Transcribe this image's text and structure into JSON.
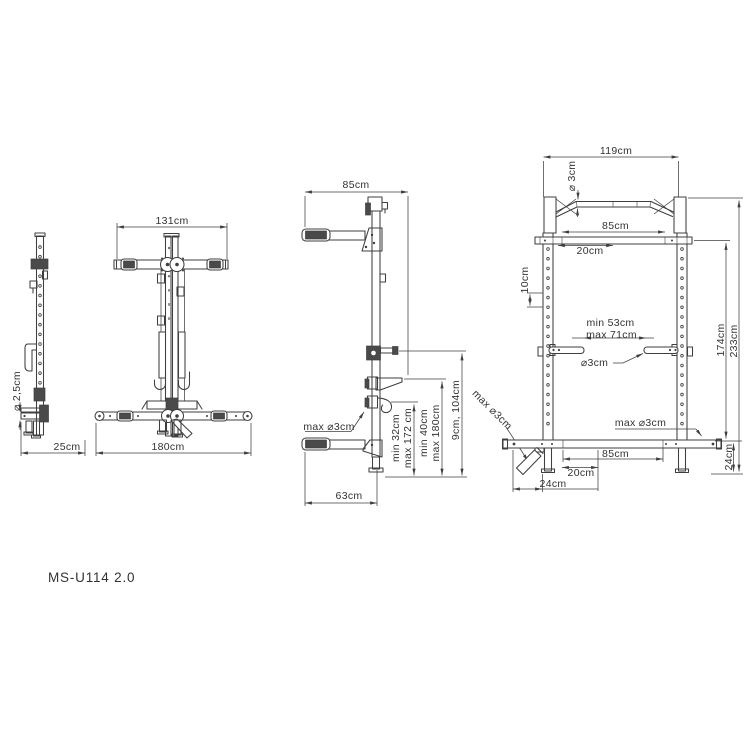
{
  "style": {
    "background": "#ffffff",
    "line_color": "#3f3f3f",
    "text_color": "#333333"
  },
  "model_label": "MS-U114 2.0",
  "views": {
    "side_folded": {
      "foot_tube_dia": "⌀ 2,5cm",
      "depth": "25cm"
    },
    "front_folded": {
      "arm_width": "131cm",
      "base_width": "180cm"
    },
    "side_profile": {
      "top_depth": "85cm",
      "jhook_bar_dia": "max ⌀3cm",
      "jhook_height_range": [
        "min 32cm",
        "max 172 cm"
      ],
      "safety_height_range": [
        "min 40cm",
        "max 180cm"
      ],
      "pin_height_range": "9cm, 104cm",
      "base_depth": "63cm",
      "plate_peg_dia": "max ⌀3cm"
    },
    "front_view": {
      "total_width": "119cm",
      "pullup_bar_dia": "⌀ 3cm",
      "handle_width": "85cm",
      "handle_offset": "20cm",
      "hole_spacing": "10cm",
      "spotter_gap": [
        "min 53cm",
        "max 71cm"
      ],
      "spotter_dia": "⌀3cm",
      "rack_height": "174cm",
      "total_height": "233cm",
      "peg_dia": "max ⌀3cm",
      "base_inner_width": "85cm",
      "base_offset": "20cm",
      "base_side_offset": "24cm",
      "base_height": "24cm"
    }
  }
}
